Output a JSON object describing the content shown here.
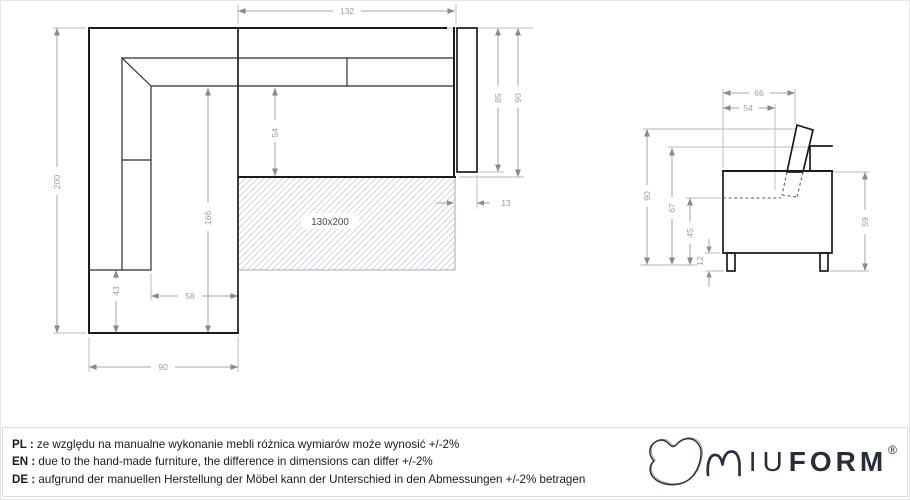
{
  "top_view": {
    "mattress_label": "130x200",
    "dim_width_top": "132",
    "dim_height_left": "200",
    "dim_depth_85": "85",
    "dim_depth_90": "90",
    "dim_offset_13": "13",
    "dim_seat_54": "54",
    "dim_chaise_len_166": "166",
    "dim_chaise_43": "43",
    "dim_chaise_seat_58": "58",
    "dim_chaise_width_90": "90"
  },
  "side_view": {
    "dim_depth_66": "66",
    "dim_seat_depth_54": "54",
    "dim_height_90": "90",
    "dim_back_height_67": "67",
    "dim_seat_height_45": "45",
    "dim_leg_height_12": "12",
    "dim_arm_height_59": "59"
  },
  "footer": {
    "disclaimers": [
      {
        "lang": "PL :",
        "text": "ze względu na manualne wykonanie mebli różnica wymiarów może wynosić +/-2%"
      },
      {
        "lang": "EN :",
        "text": "due to the hand-made furniture, the difference in dimensions can differ +/-2%"
      },
      {
        "lang": "DE :",
        "text": "aufgrund der manuellen Herstellung der Möbel kann der Unterschied in den Abmessungen +/-2% betragen"
      }
    ],
    "brand": {
      "iu": "IU",
      "form": "FORM",
      "registered": "®"
    }
  },
  "colors": {
    "outline": "#1b1b1b",
    "dimension": "#9aa0a6",
    "hatch": "#ababba",
    "brand": "#272d3a"
  }
}
